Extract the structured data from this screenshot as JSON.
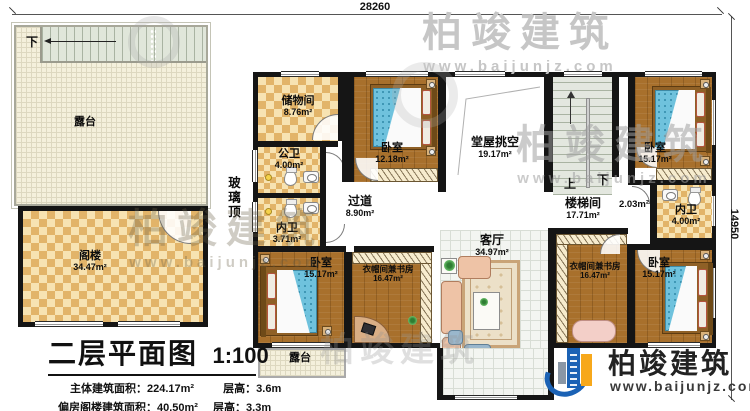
{
  "plan": {
    "dimensions": {
      "top": "28260",
      "right": "14950"
    },
    "glass_roof": "玻璃顶",
    "nav": {
      "terrace_down": "下",
      "stair_up": "上",
      "stair_down": "下"
    }
  },
  "rooms": {
    "terrace_left": {
      "label": "露台"
    },
    "attic": {
      "label": "阁楼",
      "area": "34.47m²"
    },
    "storage": {
      "label": "储物间",
      "area": "8.76m²"
    },
    "public_bath": {
      "label": "公卫",
      "area": "4.00m²"
    },
    "inner_bath_w": {
      "label": "内卫",
      "area": "3.71m²"
    },
    "bedroom_nw": {
      "label": "卧室",
      "area": "12.18m²"
    },
    "hall_void": {
      "label": "堂屋挑空",
      "area": "19.17m²"
    },
    "stairwell": {
      "label": "楼梯间",
      "area": "17.71m²"
    },
    "landing": {
      "area": "2.03m²"
    },
    "bedroom_ne": {
      "label": "卧室",
      "area": "15.17m²"
    },
    "inner_bath_e": {
      "label": "内卫",
      "area": "4.00m²"
    },
    "corridor": {
      "label": "过道",
      "area": "8.90m²"
    },
    "bedroom_sw": {
      "label": "卧室",
      "area": "15.17m²"
    },
    "cloak_study_w": {
      "label": "衣帽间兼书房",
      "area": "16.47m²"
    },
    "living": {
      "label": "客厅",
      "area": "34.97m²"
    },
    "cloak_study_e": {
      "label": "衣帽间兼书房",
      "area": "16.47m²"
    },
    "bedroom_se": {
      "label": "卧室",
      "area": "15.17m²"
    },
    "terrace_south": {
      "label": "露台"
    }
  },
  "title_block": {
    "title": "二层平面图",
    "scale": "1:100",
    "line1_label": "主体建筑面积：",
    "line1_value": "224.17m²",
    "line1_height": "层高：3.6m",
    "line2_label": "偏房阁楼建筑面积：",
    "line2_value": "40.50m²",
    "line2_height": "层高：3.3m"
  },
  "logo": {
    "name": "柏竣建筑",
    "site": "www.baijunjz.com"
  },
  "watermark": {
    "name": "柏竣建筑",
    "site": "www.baijunjz.com"
  },
  "colors": {
    "wall": "#151515",
    "wood": "#a8702c",
    "checker": "#e2b469",
    "mattress": "#6fc2dd",
    "sofa": "#eec3a6",
    "logo_blue": "#1b62b5",
    "logo_orange": "#f7a81b"
  }
}
